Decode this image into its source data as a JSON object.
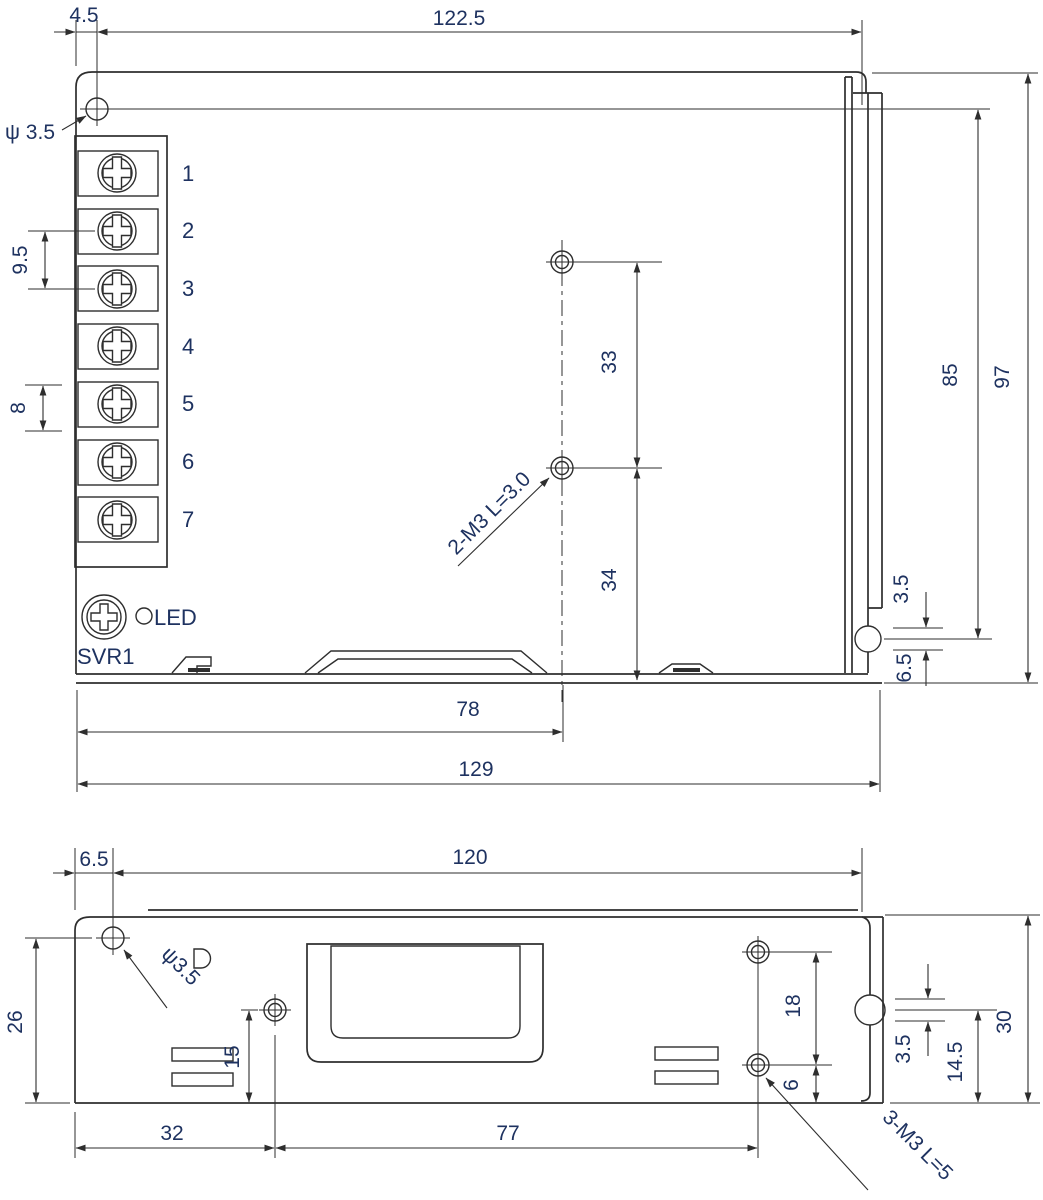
{
  "drawing_title": "power-supply-enclosure-mechanical-drawing",
  "colors": {
    "line": "#2e2e2e",
    "text": "#1e3260",
    "background": "#ffffff"
  },
  "top_view": {
    "dims": {
      "d4_5": "4.5",
      "d122_5": "122.5",
      "phi3_5": "ψ 3.5",
      "d9_5": "9.5",
      "d8": "8",
      "d33": "33",
      "d34": "34",
      "d85": "85",
      "d97": "97",
      "d3_5": "3.5",
      "d6_5": "6.5",
      "d78": "78",
      "d129": "129"
    },
    "notes": {
      "m3": "2-M3 L=3.0",
      "led": "LED",
      "svr": "SVR1"
    },
    "terminals": [
      "1",
      "2",
      "3",
      "4",
      "5",
      "6",
      "7"
    ]
  },
  "end_view": {
    "dims": {
      "d6_5": "6.5",
      "d120": "120",
      "phi3_5": "ψ3.5",
      "d26": "26",
      "d15": "15",
      "d32": "32",
      "d77": "77",
      "d18": "18",
      "d6": "6",
      "d3_5": "3.5",
      "d14_5": "14.5",
      "d30": "30"
    },
    "notes": {
      "m3": "3-M3 L=5"
    }
  }
}
